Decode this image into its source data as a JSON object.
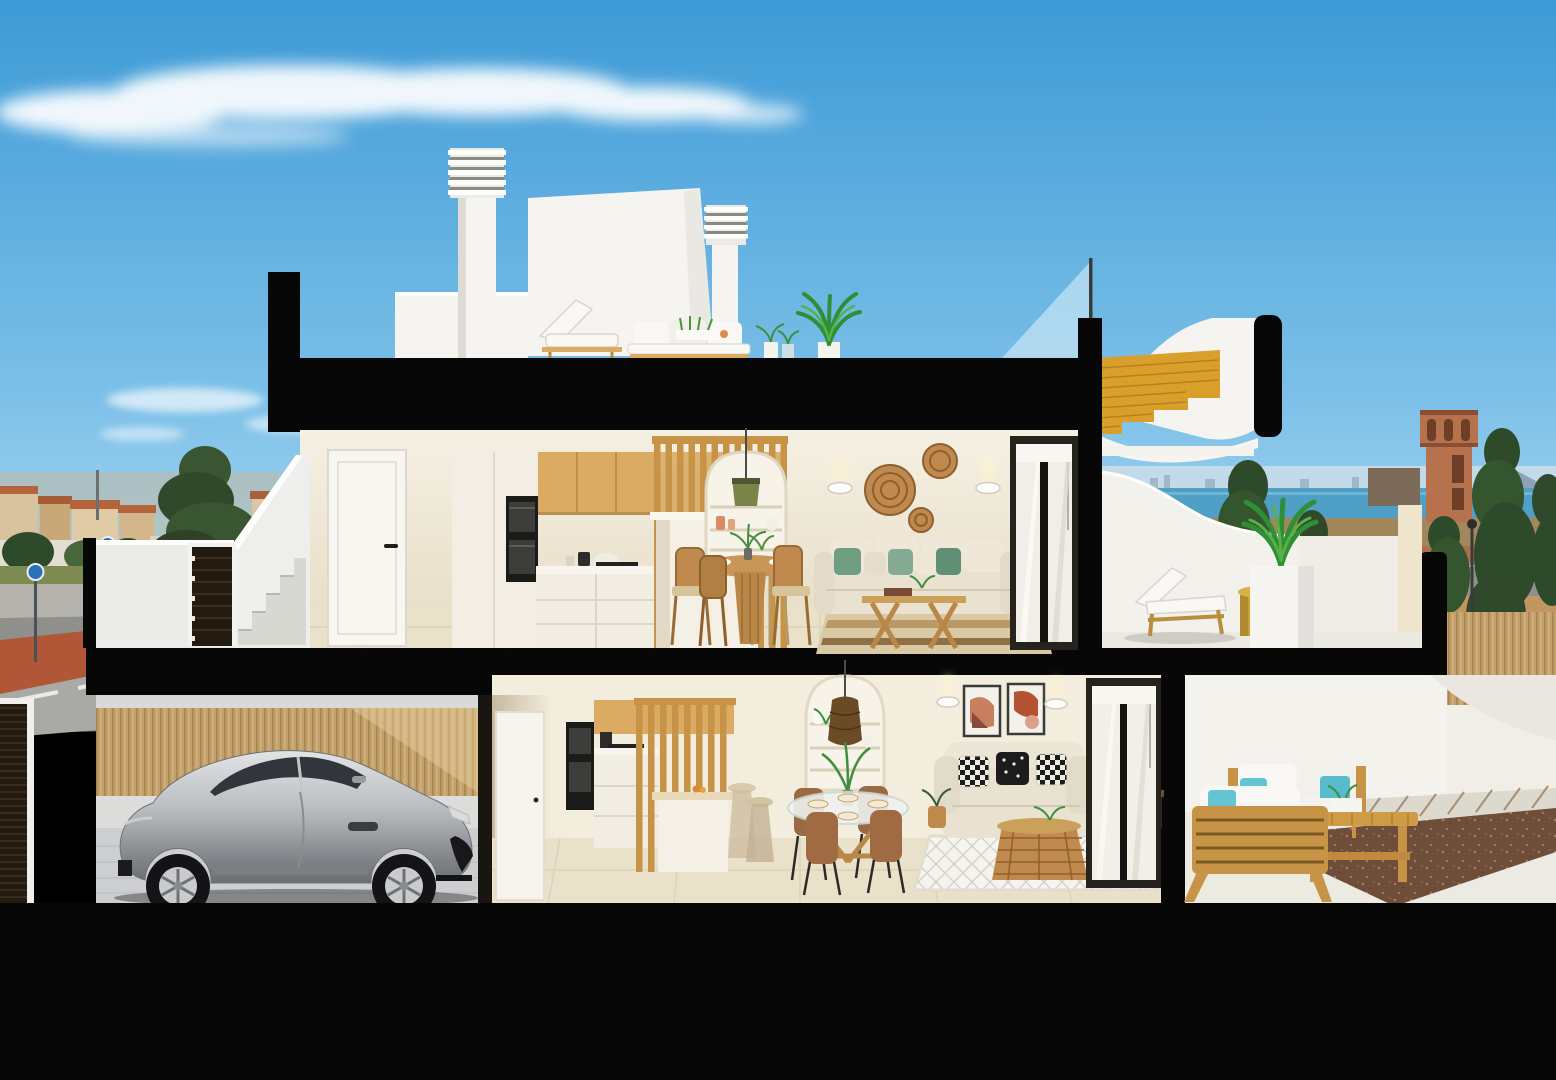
{
  "scene": {
    "type": "architectural-cutaway-render",
    "description": "Cross-section rendering of a modern two-storey townhouse with rooftop terrace, seen against a blue sky, a Mediterranean town, sea horizon and a watchtower",
    "floors": [
      {
        "name": "roof-terrace",
        "objects": [
          "chimney-with-louvers",
          "chimney-with-louvers",
          "stair-bulkhead",
          "roof-lounger",
          "roof-sofa",
          "planter-plants",
          "palm-plant",
          "glass-balustrade",
          "wooden-staircase"
        ]
      },
      {
        "name": "first-floor",
        "objects": [
          "entry-door",
          "kitchen-cabinets",
          "oven-column",
          "slat-partition",
          "kitchen-island",
          "bar-stool",
          "arched-niche",
          "pendant-lamp",
          "dining-table",
          "dining-chairs",
          "wall-sconces",
          "wicker-wall-discs",
          "corner-sofa",
          "coffee-table",
          "jute-rug",
          "sliding-glass-door",
          "terrace-sun-lounger",
          "terrace-side-table",
          "potted-palm"
        ]
      },
      {
        "name": "ground-floor",
        "objects": [
          "garage",
          "bamboo-fence",
          "garage-door",
          "sports-car",
          "kitchen-cabinets",
          "oven-column",
          "slat-partition",
          "kitchen-island",
          "bar-stools",
          "arched-niche",
          "rattan-pendant",
          "glass-dining-table",
          "dining-chairs",
          "framed-art",
          "loveseat-sofa",
          "rattan-coffee-table",
          "diamond-rug",
          "sliding-glass-door",
          "outdoor-sofa-set",
          "outdoor-bench-table",
          "gravel-bed"
        ]
      }
    ],
    "background": [
      "sky",
      "clouds",
      "town-rooftops",
      "pine-trees",
      "street-with-bike-lane",
      "road-signs",
      "sea-horizon",
      "distant-skyline",
      "mountains",
      "watchtower",
      "cypress-trees",
      "street-lamps",
      "field",
      "bamboo-fence"
    ]
  },
  "colors": {
    "sky_top": "#3d9ad6",
    "sky_mid": "#7cc0e8",
    "sky_low": "#c9e8f7",
    "cloud": "#ffffff",
    "sea": "#4f9fc6",
    "sea_haze": "#c3dbe8",
    "mountain": "#8aa3b5",
    "city_wall": "#d8b183",
    "city_roof": "#b4643a",
    "tree_dark": "#2d4a2b",
    "tree_mid": "#47663a",
    "grass": "#7d8a52",
    "field": "#c2975f",
    "scrub": "#a3875c",
    "track_red": "#ab6f4f",
    "road": "#8f8f8c",
    "sidewalk": "#b5b2ac",
    "bike_red": "#b45231",
    "cut_black": "#070707",
    "ext_white": "#f5f4f0",
    "ext_shadow": "#dddbd4",
    "wall_cream": "#f1ead9",
    "wall_shadow": "#ddd2ba",
    "floor_tile": "#e9e1ca",
    "wood": "#c79347",
    "wood_light": "#dcab63",
    "wood_dark": "#9a6a30",
    "stair_gold": "#d99f2b",
    "oven_black": "#1b1b19",
    "sofa_beige": "#e9e2d1",
    "pillow_green": "#6f9e82",
    "pillow_teal": "#65c4d2",
    "rattan": "#c08a4e",
    "car_silver": "#c3c6c9",
    "car_dark": "#7f8285",
    "car_glass": "#31363c",
    "bamboo": "#c2a06b",
    "bamboo_line": "#a9854f",
    "garage_floor": "#cdced0",
    "gravel": "#6e4e39",
    "gravel_dot": "#a07c5c",
    "terrace_white": "#f0eee7",
    "tower": "#b5724d",
    "tower_dark": "#8a4f33",
    "glass_tint": "#d7ecf6",
    "frame_dark": "#26221c",
    "lamp_glow": "#fff3cf"
  }
}
